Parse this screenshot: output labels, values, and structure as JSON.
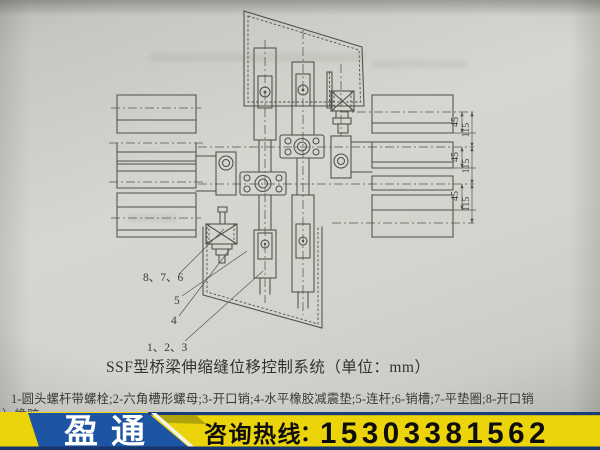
{
  "figure": {
    "caption": "SSF型桥梁伸缩缝位移控制系统（单位：mm）",
    "parts_legend": "1-圆头螺杆带螺栓;2-六角槽形螺母;3-开口销;4-水平橡胶减震垫;5-连杆;6-销槽;7-平垫圈;8-开口销",
    "partial_next_line": "）橡胶",
    "labels": {
      "group_876": "8、7、6",
      "label_5": "5",
      "label_4": "4",
      "group_123": "1、2、3"
    },
    "dimensions": {
      "gap": "45",
      "pitch": "115"
    }
  },
  "banner": {
    "logo": "盈通",
    "hotline_label": "咨询热线",
    "separator": "：",
    "phone": "15303381562",
    "colors": {
      "yellow": "#ecd40b",
      "navy": "#1d54a3",
      "navy_dark": "#16356b",
      "text": "#0d0d0d",
      "logo_text": "#ffffff"
    }
  }
}
